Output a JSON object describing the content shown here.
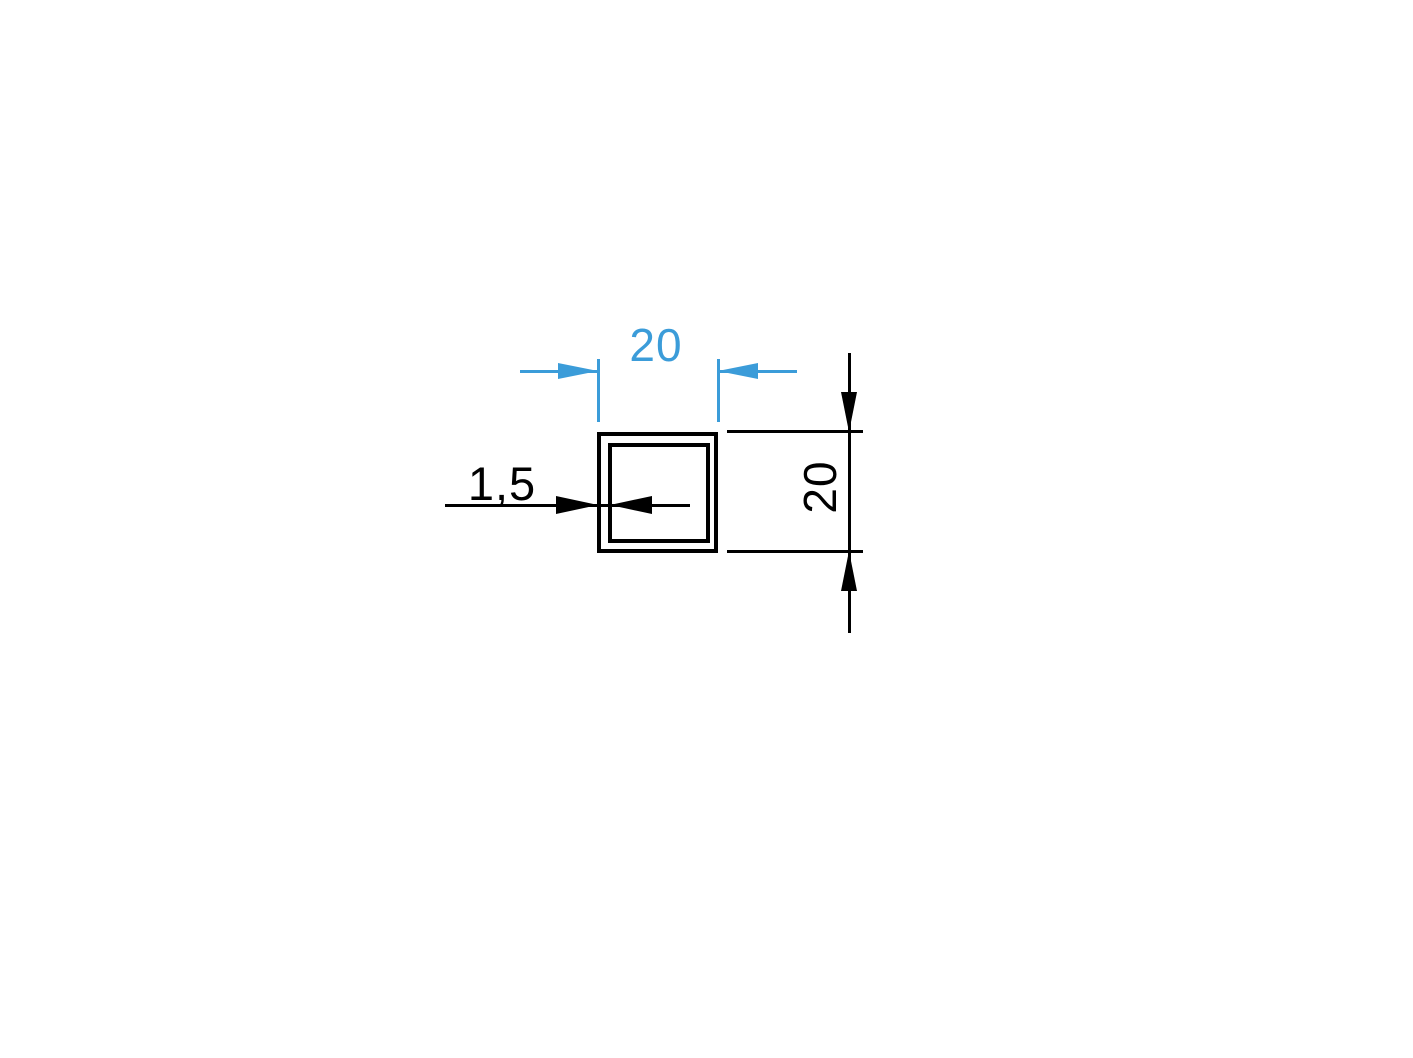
{
  "drawing": {
    "description": "Square tube cross-section technical drawing",
    "width_dim": {
      "label": "20"
    },
    "height_dim": {
      "label": "20"
    },
    "wall_dim": {
      "label": "1,5"
    },
    "colors": {
      "accent_blue": "#3B9CD9",
      "ink": "#000000",
      "background": "#FFFFFF"
    }
  }
}
